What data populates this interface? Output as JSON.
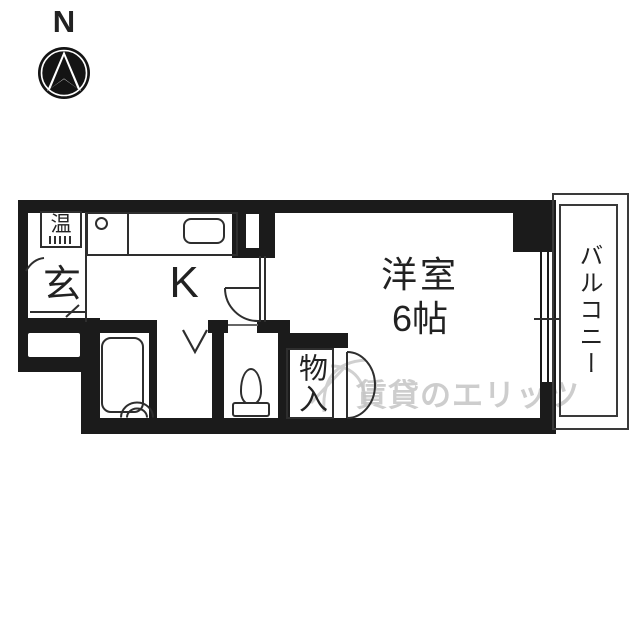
{
  "compass": {
    "label": "N"
  },
  "plan": {
    "rooms": {
      "entrance": {
        "label": "玄"
      },
      "water_heater": {
        "label": "温"
      },
      "kitchen": {
        "label": "K"
      },
      "main_room": {
        "label": "洋室",
        "size": "6帖"
      },
      "closet": {
        "label": "物入"
      },
      "balcony": {
        "label": "バルコニー"
      }
    }
  },
  "watermark": {
    "text": "賃貸のエリッツ"
  },
  "colors": {
    "wall": "#1b1b1b",
    "line": "#2e2e2e",
    "text": "#222222",
    "watermark": "#c5c5c5"
  }
}
